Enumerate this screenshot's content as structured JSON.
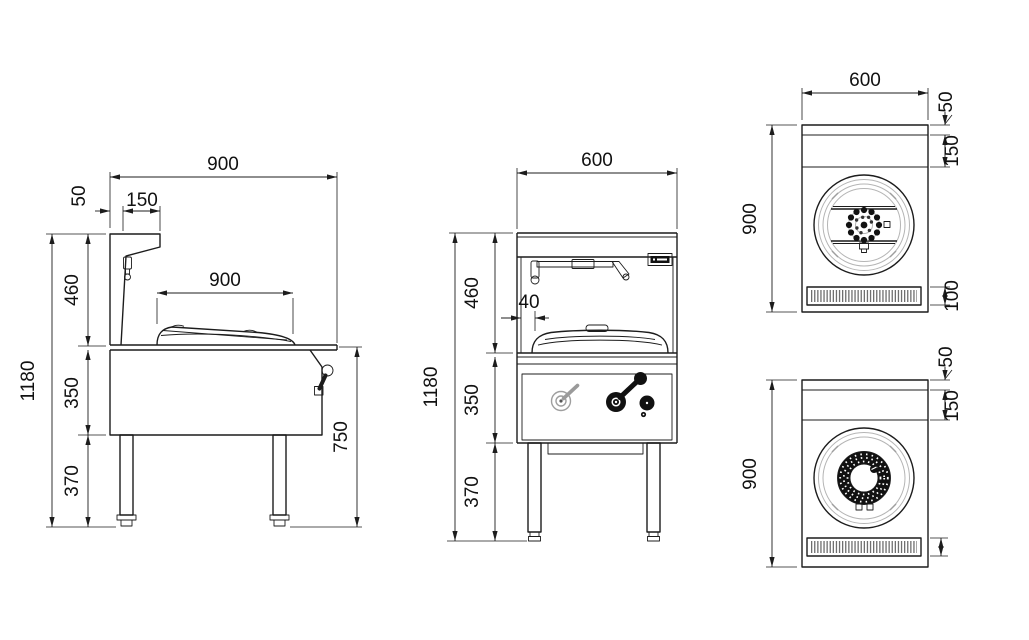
{
  "dims": {
    "side": {
      "top_width": "900",
      "splash_thickness": "50",
      "shelf_depth": "150",
      "upper_height": "460",
      "wok_width": "900",
      "total_height": "1180",
      "body_height": "350",
      "leg_height": "370",
      "worktop_height": "750"
    },
    "front": {
      "width": "600",
      "upper_height": "460",
      "wok_gap": "40",
      "total_height": "1180",
      "body_height": "350",
      "leg_height": "370"
    },
    "top_plan_a": {
      "width": "600",
      "depth": "900",
      "back_ledge": "50",
      "splash_depth": "150",
      "grille_depth": "100"
    },
    "top_plan_b": {
      "depth": "900",
      "back_ledge": "50",
      "splash_depth": "150"
    }
  },
  "colors": {
    "line": "#1c1c1c",
    "light_line": "#b5b5b5",
    "background": "#ffffff"
  }
}
